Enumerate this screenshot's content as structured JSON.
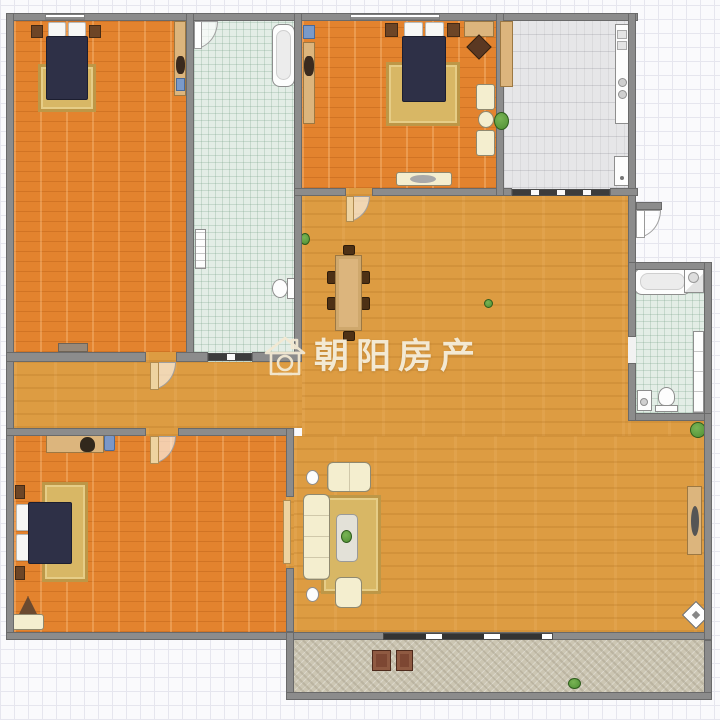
{
  "title": "apartment-floor-plan",
  "watermark": {
    "text": "朝阳房产",
    "icon": "house-camera-icon",
    "color": "#f3e9d3"
  },
  "palette": {
    "wall": "#8c8c8c",
    "wall_border": "#6a6a6a",
    "bedroom_floor": "#e3832e",
    "living_floor": "#dd9c42",
    "bath_floor": "#e3ede6",
    "kitchen_floor": "#e6e6e8",
    "balcony_floor": "#ccc6b3",
    "grid_bg": "#fafafc",
    "grid_line": "#e6e6ee",
    "bed": "#2e3047",
    "pillow": "#f7f7f5",
    "rug": "#d8b765",
    "rug_border": "#bd9747",
    "wood": "#dcb57d",
    "wood_border": "#9c7843",
    "cream": "#f4eecf",
    "cream_border": "#8f8970",
    "fixture": "#fdfdfd",
    "fixture_border": "#8e8e8e",
    "door_leaf": "#eed3a0",
    "plant_green": "#4f8f33",
    "watermark": "#f3e9d3"
  },
  "rooms": [
    {
      "id": "bedroom-top-left",
      "floor": "wood-brick",
      "furniture": [
        "double-bed",
        "two-pillows",
        "rug",
        "two-nightstands",
        "wardrobe",
        "dresser",
        "window"
      ]
    },
    {
      "id": "bathroom-center-top",
      "floor": "mint-tile",
      "furniture": [
        "swing-door",
        "bathtub",
        "radiator",
        "toilet",
        "sliding-door"
      ]
    },
    {
      "id": "bedroom-top-center",
      "floor": "wood-brick",
      "furniture": [
        "double-bed",
        "two-pillows",
        "rug",
        "two-nightstands",
        "wardrobe",
        "corner-tv-unit",
        "two-armchairs",
        "round-side-table",
        "dresser",
        "plant",
        "window",
        "swing-door"
      ]
    },
    {
      "id": "kitchen-top-right",
      "floor": "gray-tile",
      "furniture": [
        "tall-cabinet",
        "counter-with-sink",
        "stove-two-burners",
        "fridge",
        "sliding-door"
      ]
    },
    {
      "id": "living-dining-room",
      "floor": "wood-parquet",
      "furniture": [
        "dining-table-with-six-chairs",
        "three-seat-sofa",
        "loveseat",
        "armchair",
        "coffee-table",
        "rug",
        "two-lamps",
        "console-table",
        "three-plants",
        "diamond-decor"
      ]
    },
    {
      "id": "hallway",
      "floor": "wood-parquet",
      "furniture": []
    },
    {
      "id": "bedroom-bottom-left",
      "floor": "wood-brick",
      "furniture": [
        "double-bed",
        "two-pillows",
        "rug",
        "two-nightstands",
        "desk",
        "desk-chair",
        "computer",
        "corner-plant-stand",
        "dresser",
        "swing-door"
      ]
    },
    {
      "id": "bathroom-right",
      "floor": "mint-tile",
      "furniture": [
        "bathtub",
        "corner-sink",
        "toilet",
        "washing-machine",
        "cabinet-column"
      ]
    },
    {
      "id": "balcony-bottom",
      "floor": "stone-tile",
      "furniture": [
        "two-chairs",
        "plant",
        "sliding-door"
      ]
    },
    {
      "id": "entry",
      "floor": "none",
      "furniture": [
        "entry-swing-door"
      ]
    }
  ]
}
